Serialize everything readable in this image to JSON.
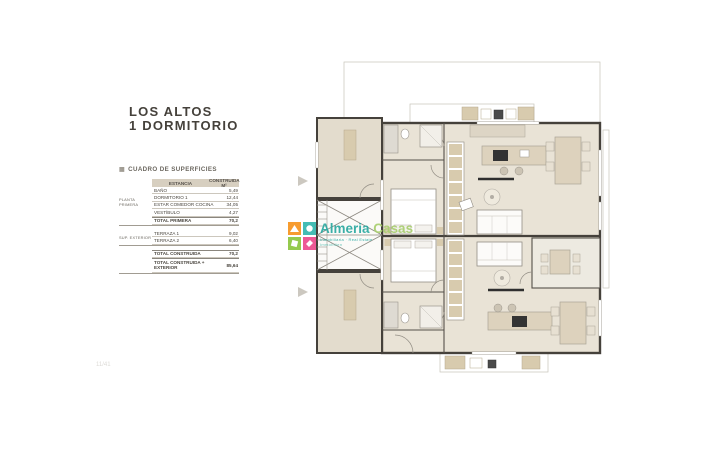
{
  "title": {
    "line1": "LOS ALTOS",
    "line2": "1 DORMITORIO"
  },
  "surfaces": {
    "heading": "CUADRO DE SUPERFICIES",
    "heading_icon_glyph": "▦",
    "col_room": "ESTANCIA",
    "col_built": "CONSTRUIDA M²",
    "group1_label": "PLANTA PRIMERA",
    "group2_label": "SUP. EXTERIOR",
    "rows": [
      {
        "label": "BAÑO",
        "value": "5,49"
      },
      {
        "label": "DORMITORIO 1",
        "value": "12,44"
      },
      {
        "label": "ESTAR COMEDOR COCINA",
        "value": "34,05"
      },
      {
        "label": "VESTÍBULO",
        "value": "4,27"
      },
      {
        "label": "TOTAL PRIMERA",
        "value": "70,2"
      },
      {
        "label": "TERRAZA 1",
        "value": "9,02"
      },
      {
        "label": "TERRAZA 2",
        "value": "6,40"
      },
      {
        "label": "TOTAL CONSTRUIDA",
        "value": "70,2"
      },
      {
        "label": "TOTAL CONSTRUIDA + EXTERIOR",
        "value": "85,64"
      }
    ]
  },
  "watermark": {
    "brand_bold": "Almeria",
    "brand_light": "Casas",
    "tagline1": "Inmobiliaria · Real Estate",
    "tagline2": "Immobilien",
    "colors": {
      "teal": "#2ba9a1",
      "orange": "#f7941e",
      "green": "#8dc63f",
      "pink": "#ec4b8d"
    }
  },
  "footer": {
    "page_number": "11/41"
  },
  "plan": {
    "type": "floor-plan",
    "colors": {
      "wall": "#45413b",
      "room_fill": "#e9e3d6",
      "annex_fill": "#e3dccd",
      "furniture_beige": "#ddd2bd",
      "appliance_dark": "#333333",
      "thin_line": "#c7c3ba"
    }
  }
}
